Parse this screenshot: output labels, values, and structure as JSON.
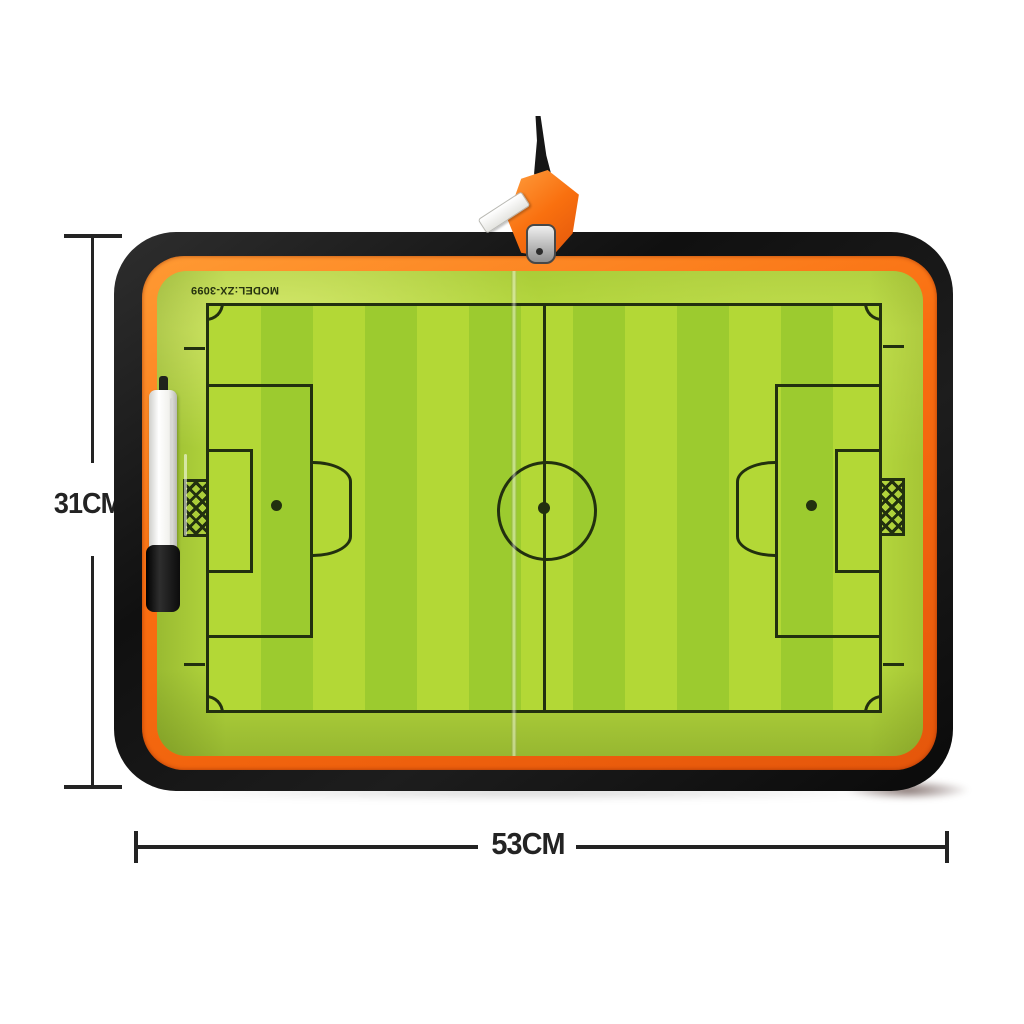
{
  "product": {
    "model_text": "MODEL:ZX-3099",
    "height_label": "31CM",
    "width_label": "53CM"
  },
  "colors": {
    "panel_green": "#b6da3e",
    "stripe_light": "#b3d836",
    "stripe_dark": "#9ccb2f",
    "pitch_line": "#22300f",
    "case_black": "#161616",
    "trim_orange": "#f96d10",
    "pen_body": "#f4f4f0",
    "pen_cap": "#141414",
    "zipper_metal": "#bdbdbd",
    "pull_tab_white": "#f5f5f2",
    "dimension_line": "#232323",
    "background": "#ffffff"
  }
}
